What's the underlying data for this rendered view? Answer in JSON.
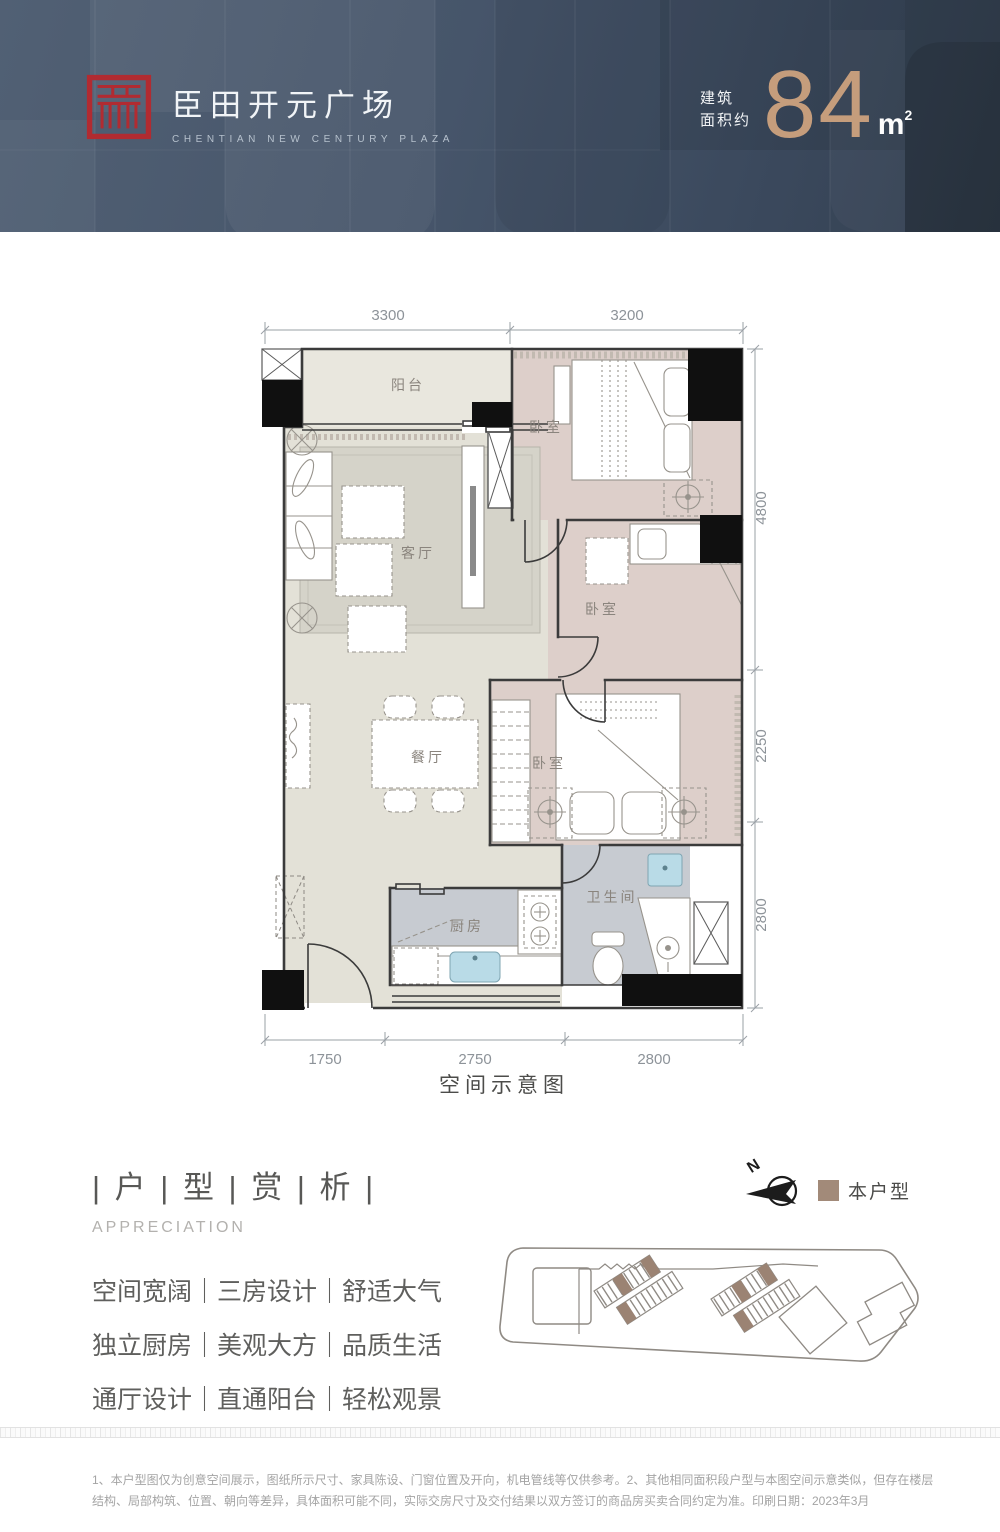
{
  "header": {
    "brand_cn": "臣田开元广场",
    "brand_en": "CHENTIAN NEW CENTURY PLAZA",
    "area_label_line1": "建筑",
    "area_label_line2": "面积约",
    "area_value": "84",
    "area_unit": "m",
    "area_unit_exp": "2"
  },
  "floorplan": {
    "caption": "空间示意图",
    "rooms": [
      {
        "id": "balcony",
        "label": "阳台"
      },
      {
        "id": "living-room",
        "label": "客厅"
      },
      {
        "id": "bedroom-top",
        "label": "卧室"
      },
      {
        "id": "bedroom-middle",
        "label": "卧室"
      },
      {
        "id": "bedroom-lower",
        "label": "卧室"
      },
      {
        "id": "dining-room",
        "label": "餐厅"
      },
      {
        "id": "kitchen",
        "label": "厨房"
      },
      {
        "id": "bathroom",
        "label": "卫生间"
      }
    ],
    "dimensions_mm": {
      "top": [
        "3300",
        "3200"
      ],
      "right": [
        "4800",
        "2250",
        "2800"
      ],
      "bottom": [
        "1750",
        "2750",
        "2800"
      ]
    }
  },
  "appreciation": {
    "title": "| 户 | 型 | 赏 | 析 |",
    "subtitle": "APPRECIATION",
    "selling_points": [
      "空间宽阔｜三房设计｜舒适大气",
      "独立厨房｜美观大方｜品质生活",
      "通厅设计｜直通阳台｜轻松观景"
    ]
  },
  "siteplan": {
    "compass_letter": "N",
    "legend_this_unit": "本户型",
    "highlight_color": "#9b8373"
  },
  "footer": {
    "disclaimer": "1、本户型图仅为创意空间展示，图纸所示尺寸、家具陈设、门窗位置及开向，机电管线等仅供参考。2、其他相同面积段户型与本图空间示意类似，但存在楼层结构、局部构筑、位置、朝向等差异，具体面积可能不同，实际交房尺寸及交付结果以双方签订的商品房买卖合同约定为准。印刷日期：2023年3月"
  },
  "colors": {
    "header_bg": "#46556a",
    "accent_bronze": "#c59d7c",
    "logo_red": "#b12b31",
    "floor_beige": "#e3e1d7",
    "floor_pink": "#ddcfca",
    "floor_gray": "#c7cbd1"
  }
}
